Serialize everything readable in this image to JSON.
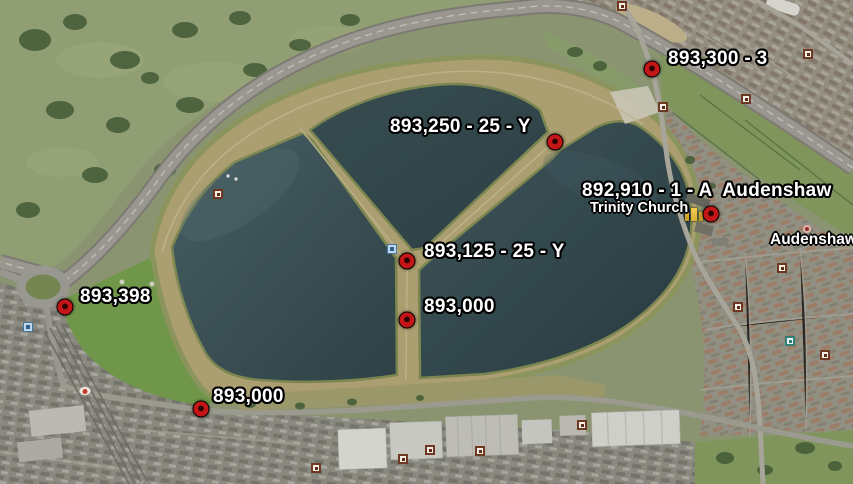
{
  "map": {
    "description": "Aerial satellite view of Audenshaw Reservoirs with survey placemarks",
    "colors": {
      "marker_red": "#c41616",
      "label_text": "#ffffff",
      "label_outline": "#000000",
      "water_light": "#4c666b",
      "water_dark": "#2f4347",
      "embankment_tan": "#b9ab7a"
    },
    "markers": [
      {
        "label": "893,300 - 3",
        "x": 652,
        "y": 69,
        "label_x": 668,
        "label_y": 48
      },
      {
        "label": "893,250 - 25 - Y",
        "x": 555,
        "y": 142,
        "label_x": 390,
        "label_y": 116
      },
      {
        "label": "892,910 - 1 - A  Audenshaw",
        "x": 711,
        "y": 214,
        "label_x": 582,
        "label_y": 180
      },
      {
        "label": "893,125 - 25 - Y",
        "x": 407,
        "y": 261,
        "label_x": 424,
        "label_y": 241
      },
      {
        "label": "893,000",
        "x": 407,
        "y": 320,
        "label_x": 424,
        "label_y": 296
      },
      {
        "label": "893,398",
        "x": 65,
        "y": 307,
        "label_x": 80,
        "label_y": 286
      },
      {
        "label": "893,000",
        "x": 201,
        "y": 409,
        "label_x": 213,
        "label_y": 386
      }
    ],
    "place_labels": [
      {
        "text": "Trinity Church",
        "x": 590,
        "y": 200,
        "kind": "poi"
      },
      {
        "text": "Audenshaw",
        "x": 770,
        "y": 231,
        "kind": "district"
      }
    ],
    "minor_icons": [
      {
        "type": "survey-square",
        "x": 808,
        "y": 54,
        "interactable": true
      },
      {
        "type": "survey-square",
        "x": 746,
        "y": 99,
        "interactable": true
      },
      {
        "type": "survey-square",
        "x": 663,
        "y": 107,
        "interactable": true
      },
      {
        "type": "survey-square",
        "x": 622,
        "y": 6,
        "interactable": true
      },
      {
        "type": "survey-square",
        "x": 782,
        "y": 268,
        "interactable": true
      },
      {
        "type": "survey-square",
        "x": 738,
        "y": 307,
        "interactable": true
      },
      {
        "type": "survey-square",
        "x": 825,
        "y": 355,
        "interactable": true
      },
      {
        "type": "survey-square",
        "x": 403,
        "y": 459,
        "interactable": true
      },
      {
        "type": "survey-square",
        "x": 430,
        "y": 450,
        "interactable": true
      },
      {
        "type": "survey-square",
        "x": 480,
        "y": 451,
        "interactable": true
      },
      {
        "type": "survey-square",
        "x": 582,
        "y": 425,
        "interactable": true
      },
      {
        "type": "survey-square",
        "x": 316,
        "y": 468,
        "interactable": true
      },
      {
        "type": "survey-square",
        "x": 218,
        "y": 194,
        "interactable": true
      },
      {
        "type": "teal-square",
        "x": 790,
        "y": 341,
        "interactable": true
      },
      {
        "type": "blue-info",
        "x": 392,
        "y": 249,
        "interactable": true
      },
      {
        "type": "blue-info",
        "x": 28,
        "y": 327,
        "interactable": true
      },
      {
        "type": "church-icon",
        "x": 694,
        "y": 214,
        "interactable": true
      },
      {
        "type": "pink-dot",
        "x": 807,
        "y": 229,
        "interactable": false
      },
      {
        "type": "white-oval",
        "x": 85,
        "y": 391,
        "interactable": false
      }
    ]
  }
}
